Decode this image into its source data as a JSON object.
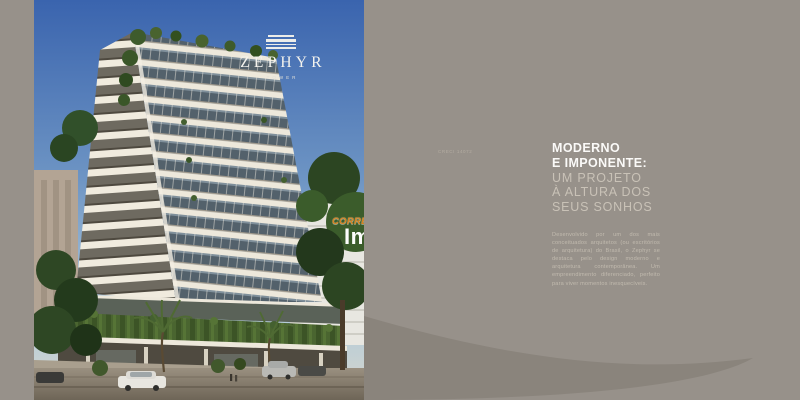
{
  "photo": {
    "logo_title": "ZEPHYR",
    "logo_subtitle": "TOWER"
  },
  "watermark": {
    "monogram_a": "A",
    "monogram_s": "S",
    "tagline": "CORRETOR DE",
    "brand": "Imóveis"
  },
  "panel": {
    "creci": "CRECI 14072",
    "headline_bold": [
      "MODERNO",
      "E IMPONENTE:"
    ],
    "headline_light": [
      "UM PROJETO",
      "À ALTURA DOS",
      "SEUS SONHOS"
    ],
    "body": "Desenvolvido por um dos mais conceituados arquitetos (ou escritórios de arquitetura) do Brasil, o Zephyr se destaca pelo design moderno e arquitetura contemporânea. Um empreendimento diferenciado, perfeito para viver momentos inesquecíveis."
  },
  "colors": {
    "panel_bg": "#97918A",
    "swoosh": "#8A847C",
    "heading_white": "#FBFAF8",
    "heading_light": "#C9C2B7",
    "body_text": "#C2BBAF",
    "accent_orange": "#D8821F",
    "sky_top": "#3A64AE",
    "slab_cream": "#EDE8DB",
    "greenery": "#4A6530"
  }
}
